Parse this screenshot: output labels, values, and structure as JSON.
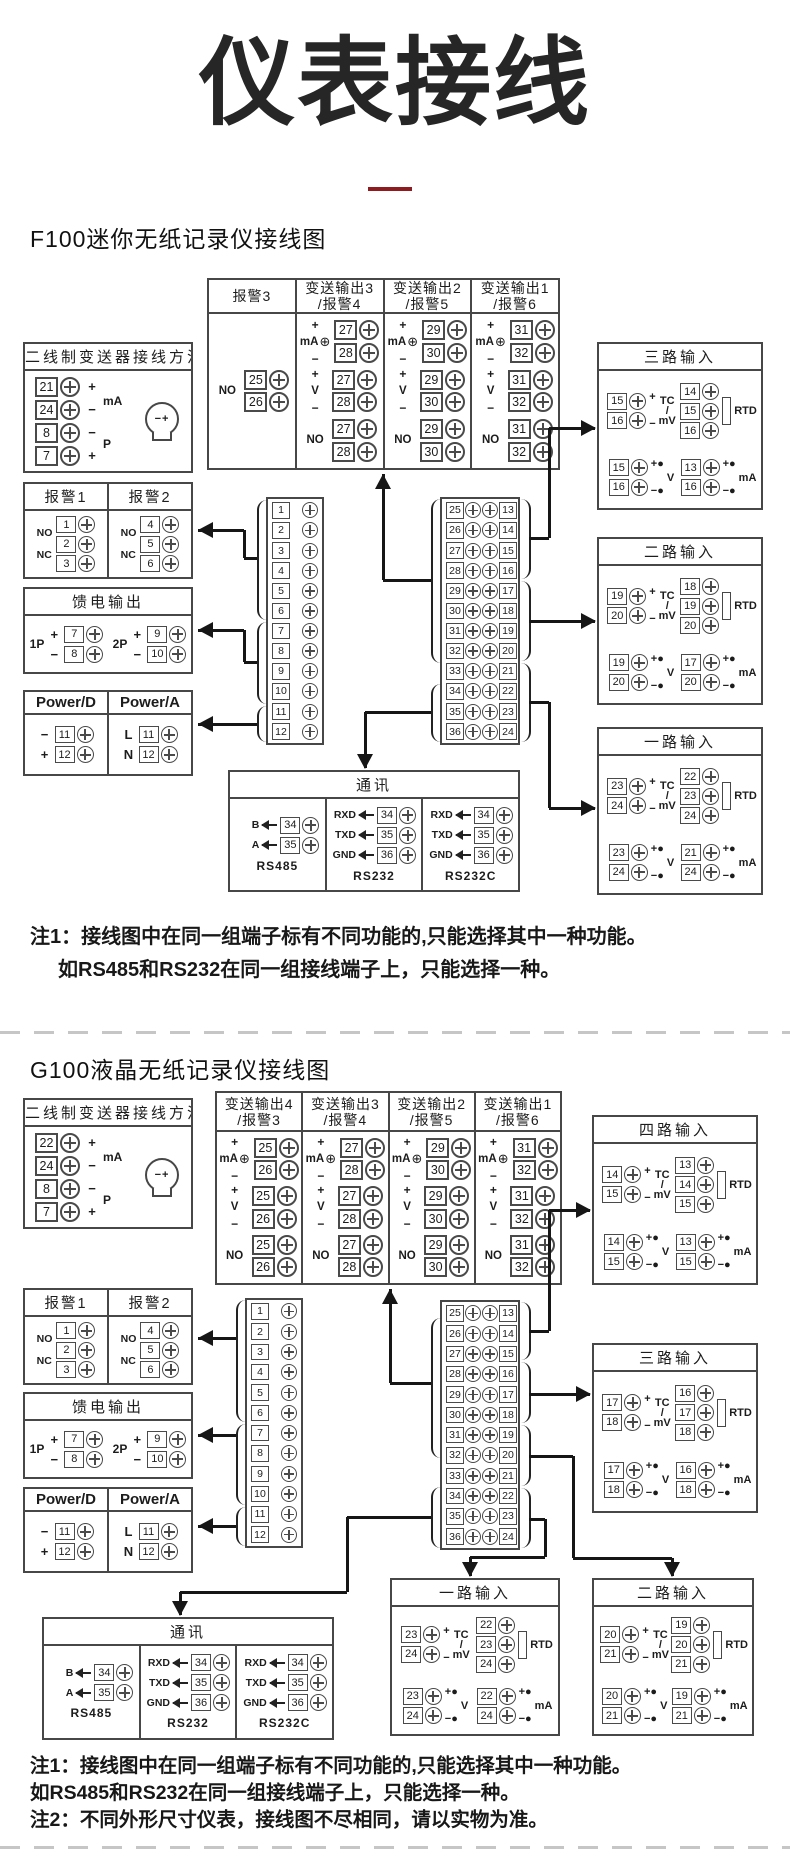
{
  "page": {
    "title": "仪表接线",
    "underline_color": "#8e1b1f",
    "notes_f100": [
      "注1：接线图中在同一组端子标有不同功能的,只能选择其中一种功能。",
      "如RS485和RS232在同一组接线端子上，只能选择一种。"
    ],
    "notes_g100": [
      "注1：接线图中在同一组端子标有不同功能的,只能选择其中一种功能。",
      "如RS485和RS232在同一组接线端子上，只能选择一种。",
      "注2：不同外形尺寸仪表，接线图不尽相同，请以实物为准。"
    ]
  },
  "labels": {
    "plus": "+",
    "minus": "−",
    "ma": "mA",
    "v": "V",
    "tc": "TC",
    "slash": "/",
    "mv": "mV",
    "rtd": "RTD",
    "no": "NO",
    "nc": "NC",
    "p": "P",
    "oplus": "⊕",
    "dot": "●",
    "xminus": "−",
    "xplus": "+"
  },
  "f100": {
    "heading": "F100迷你无纸记录仪接线图",
    "transmitter": {
      "title": "二线制变送器接线方法",
      "terminals": [
        {
          "num": "21",
          "sign": "+"
        },
        {
          "num": "24",
          "sign": "−"
        },
        {
          "num": "8",
          "sign": "−"
        },
        {
          "num": "7",
          "sign": "+"
        }
      ],
      "mid_labels": [
        "mA",
        "P"
      ]
    },
    "alarms": {
      "columns": [
        {
          "title": "报警1",
          "terminals": [
            "1",
            "2",
            "3"
          ]
        },
        {
          "title": "报警2",
          "terminals": [
            "4",
            "5",
            "6"
          ]
        }
      ],
      "contacts": [
        "NO",
        "NC"
      ]
    },
    "feed": {
      "title": "馈电输出",
      "groups": [
        {
          "label": "1P",
          "terminals": [
            {
              "num": "7",
              "sign": "+"
            },
            {
              "num": "8",
              "sign": "−"
            }
          ]
        },
        {
          "label": "2P",
          "terminals": [
            {
              "num": "9",
              "sign": "+"
            },
            {
              "num": "10",
              "sign": "−"
            }
          ]
        }
      ]
    },
    "power": {
      "columns": [
        {
          "title": "Power/D",
          "terminals": [
            {
              "num": "11",
              "sign": "−"
            },
            {
              "num": "12",
              "sign": "+"
            }
          ]
        },
        {
          "title": "Power/A",
          "terminals": [
            {
              "num": "11",
              "sign": "L"
            },
            {
              "num": "12",
              "sign": "N"
            }
          ]
        }
      ]
    },
    "output_table": {
      "columns": [
        {
          "title": "报警3",
          "subtitle": "",
          "groups": [
            {
              "type": "NO",
              "terminals": [
                "25",
                "26"
              ]
            }
          ]
        },
        {
          "title": "变送输出3",
          "subtitle": "/报警4",
          "groups": [
            {
              "type": "mA",
              "terminals": [
                "27",
                "28"
              ]
            },
            {
              "type": "V",
              "terminals": [
                "27",
                "28"
              ]
            },
            {
              "type": "NO",
              "terminals": [
                "27",
                "28"
              ]
            }
          ]
        },
        {
          "title": "变送输出2",
          "subtitle": "/报警5",
          "groups": [
            {
              "type": "mA",
              "terminals": [
                "29",
                "30"
              ]
            },
            {
              "type": "V",
              "terminals": [
                "29",
                "30"
              ]
            },
            {
              "type": "NO",
              "terminals": [
                "29",
                "30"
              ]
            }
          ]
        },
        {
          "title": "变送输出1",
          "subtitle": "/报警6",
          "groups": [
            {
              "type": "mA",
              "terminals": [
                "31",
                "32"
              ]
            },
            {
              "type": "V",
              "terminals": [
                "31",
                "32"
              ]
            },
            {
              "type": "NO",
              "terminals": [
                "31",
                "32"
              ]
            }
          ]
        }
      ]
    },
    "strip_left": [
      "1",
      "2",
      "3",
      "4",
      "5",
      "6",
      "7",
      "8",
      "9",
      "10",
      "11",
      "12"
    ],
    "strip_right_left": [
      "25",
      "26",
      "27",
      "28",
      "29",
      "30",
      "31",
      "32",
      "33",
      "34",
      "35",
      "36"
    ],
    "strip_right_right": [
      "13",
      "14",
      "15",
      "16",
      "17",
      "18",
      "19",
      "20",
      "21",
      "22",
      "23",
      "24"
    ],
    "inputs": [
      {
        "title": "三路输入",
        "tc": [
          "15",
          "16"
        ],
        "rtd": [
          "14",
          "15",
          "16"
        ],
        "v": [
          "15",
          "16"
        ],
        "ma": [
          "13",
          "16"
        ]
      },
      {
        "title": "二路输入",
        "tc": [
          "19",
          "20"
        ],
        "rtd": [
          "18",
          "19",
          "20"
        ],
        "v": [
          "19",
          "20"
        ],
        "ma": [
          "17",
          "20"
        ]
      },
      {
        "title": "一路输入",
        "tc": [
          "23",
          "24"
        ],
        "rtd": [
          "22",
          "23",
          "24"
        ],
        "v": [
          "23",
          "24"
        ],
        "ma": [
          "21",
          "24"
        ]
      }
    ],
    "comm": {
      "title": "通讯",
      "groups": [
        {
          "caption": "RS485",
          "rows": [
            {
              "label": "B",
              "num": "34"
            },
            {
              "label": "A",
              "num": "35"
            }
          ]
        },
        {
          "caption": "RS232",
          "rows": [
            {
              "label": "RXD",
              "num": "34"
            },
            {
              "label": "TXD",
              "num": "35"
            },
            {
              "label": "GND",
              "num": "36"
            }
          ]
        },
        {
          "caption": "RS232C",
          "rows": [
            {
              "label": "RXD",
              "num": "34"
            },
            {
              "label": "TXD",
              "num": "35"
            },
            {
              "label": "GND",
              "num": "36"
            }
          ]
        }
      ]
    }
  },
  "g100": {
    "heading": "G100液晶无纸记录仪接线图",
    "transmitter": {
      "title": "二线制变送器接线方法",
      "terminals": [
        {
          "num": "22",
          "sign": "+"
        },
        {
          "num": "24",
          "sign": "−"
        },
        {
          "num": "8",
          "sign": "−"
        },
        {
          "num": "7",
          "sign": "+"
        }
      ],
      "mid_labels": [
        "mA",
        "P"
      ]
    },
    "alarms": {
      "columns": [
        {
          "title": "报警1",
          "terminals": [
            "1",
            "2",
            "3"
          ]
        },
        {
          "title": "报警2",
          "terminals": [
            "4",
            "5",
            "6"
          ]
        }
      ],
      "contacts": [
        "NO",
        "NC"
      ]
    },
    "feed": {
      "title": "馈电输出",
      "groups": [
        {
          "label": "1P",
          "terminals": [
            {
              "num": "7",
              "sign": "+"
            },
            {
              "num": "8",
              "sign": "−"
            }
          ]
        },
        {
          "label": "2P",
          "terminals": [
            {
              "num": "9",
              "sign": "+"
            },
            {
              "num": "10",
              "sign": "−"
            }
          ]
        }
      ]
    },
    "power": {
      "columns": [
        {
          "title": "Power/D",
          "terminals": [
            {
              "num": "11",
              "sign": "−"
            },
            {
              "num": "12",
              "sign": "+"
            }
          ]
        },
        {
          "title": "Power/A",
          "terminals": [
            {
              "num": "11",
              "sign": "L"
            },
            {
              "num": "12",
              "sign": "N"
            }
          ]
        }
      ]
    },
    "output_table": {
      "columns": [
        {
          "title": "变送输出4",
          "subtitle": "/报警3",
          "groups": [
            {
              "type": "mA",
              "terminals": [
                "25",
                "26"
              ]
            },
            {
              "type": "V",
              "terminals": [
                "25",
                "26"
              ]
            },
            {
              "type": "NO",
              "terminals": [
                "25",
                "26"
              ]
            }
          ]
        },
        {
          "title": "变送输出3",
          "subtitle": "/报警4",
          "groups": [
            {
              "type": "mA",
              "terminals": [
                "27",
                "28"
              ]
            },
            {
              "type": "V",
              "terminals": [
                "27",
                "28"
              ]
            },
            {
              "type": "NO",
              "terminals": [
                "27",
                "28"
              ]
            }
          ]
        },
        {
          "title": "变送输出2",
          "subtitle": "/报警5",
          "groups": [
            {
              "type": "mA",
              "terminals": [
                "29",
                "30"
              ]
            },
            {
              "type": "V",
              "terminals": [
                "29",
                "30"
              ]
            },
            {
              "type": "NO",
              "terminals": [
                "29",
                "30"
              ]
            }
          ]
        },
        {
          "title": "变送输出1",
          "subtitle": "/报警6",
          "groups": [
            {
              "type": "mA",
              "terminals": [
                "31",
                "32"
              ]
            },
            {
              "type": "V",
              "terminals": [
                "31",
                "32"
              ]
            },
            {
              "type": "NO",
              "terminals": [
                "31",
                "32"
              ]
            }
          ]
        }
      ]
    },
    "strip_left": [
      "1",
      "2",
      "3",
      "4",
      "5",
      "6",
      "7",
      "8",
      "9",
      "10",
      "11",
      "12"
    ],
    "strip_right_left": [
      "25",
      "26",
      "27",
      "28",
      "29",
      "30",
      "31",
      "32",
      "33",
      "34",
      "35",
      "36"
    ],
    "strip_right_right": [
      "13",
      "14",
      "15",
      "16",
      "17",
      "18",
      "19",
      "20",
      "21",
      "22",
      "23",
      "24"
    ],
    "inputs": [
      {
        "title": "四路输入",
        "tc": [
          "14",
          "15"
        ],
        "rtd": [
          "13",
          "14",
          "15"
        ],
        "v": [
          "14",
          "15"
        ],
        "ma": [
          "13",
          "15"
        ]
      },
      {
        "title": "三路输入",
        "tc": [
          "17",
          "18"
        ],
        "rtd": [
          "16",
          "17",
          "18"
        ],
        "v": [
          "17",
          "18"
        ],
        "ma": [
          "16",
          "18"
        ]
      },
      {
        "title": "一路输入",
        "tc": [
          "23",
          "24"
        ],
        "rtd": [
          "22",
          "23",
          "24"
        ],
        "v": [
          "23",
          "24"
        ],
        "ma": [
          "22",
          "24"
        ]
      },
      {
        "title": "二路输入",
        "tc": [
          "20",
          "21"
        ],
        "rtd": [
          "19",
          "20",
          "21"
        ],
        "v": [
          "20",
          "21"
        ],
        "ma": [
          "19",
          "21"
        ]
      }
    ],
    "comm": {
      "title": "通讯",
      "groups": [
        {
          "caption": "RS485",
          "rows": [
            {
              "label": "B",
              "num": "34"
            },
            {
              "label": "A",
              "num": "35"
            }
          ]
        },
        {
          "caption": "RS232",
          "rows": [
            {
              "label": "RXD",
              "num": "34"
            },
            {
              "label": "TXD",
              "num": "35"
            },
            {
              "label": "GND",
              "num": "36"
            }
          ]
        },
        {
          "caption": "RS232C",
          "rows": [
            {
              "label": "RXD",
              "num": "34"
            },
            {
              "label": "TXD",
              "num": "35"
            },
            {
              "label": "GND",
              "num": "36"
            }
          ]
        }
      ]
    }
  }
}
